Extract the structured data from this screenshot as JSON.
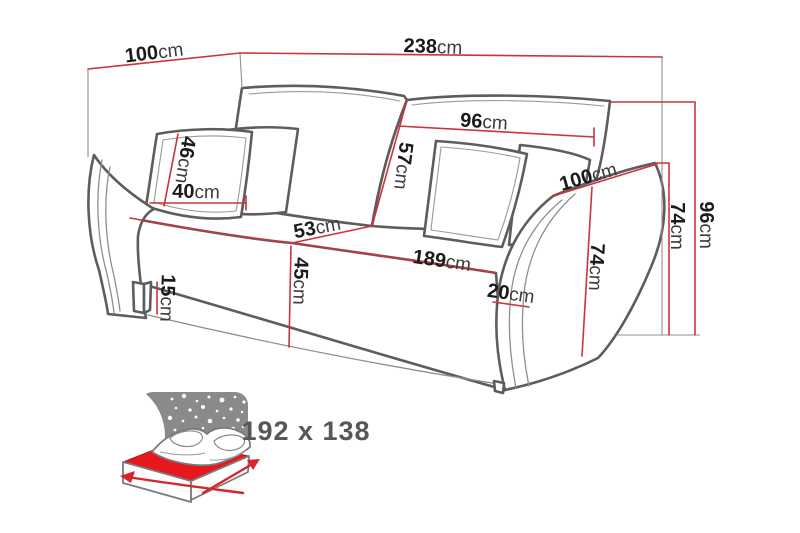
{
  "diagram": {
    "type": "sofa-bed dimension drawing",
    "unit_default": "cm"
  },
  "dims": {
    "total_width": {
      "value": "238",
      "unit": "cm"
    },
    "total_depth": {
      "value": "100",
      "unit": "cm"
    },
    "total_height": {
      "value": "96",
      "unit": "cm"
    },
    "back_cushion_width": {
      "value": "96",
      "unit": "cm"
    },
    "back_cushion_height": {
      "value": "57",
      "unit": "cm"
    },
    "pillow_height": {
      "value": "46",
      "unit": "cm"
    },
    "pillow_width": {
      "value": "40",
      "unit": "cm"
    },
    "seat_depth": {
      "value": "53",
      "unit": "cm"
    },
    "seat_height": {
      "value": "45",
      "unit": "cm"
    },
    "seat_width": {
      "value": "189",
      "unit": "cm"
    },
    "leg_height": {
      "value": "15",
      "unit": "cm"
    },
    "armrest_width": {
      "value": "20",
      "unit": "cm"
    },
    "armrest_depth": {
      "value": "100",
      "unit": "cm"
    },
    "armrest_height": {
      "value": "74",
      "unit": "cm"
    },
    "armrest_height_inner": {
      "value": "74",
      "unit": "cm"
    }
  },
  "sleeping_area": {
    "label": "192 x 138",
    "icon": "bed-night-sky-icon"
  },
  "colors": {
    "dimension_line": "#cb3339",
    "sofa_outline": "#5d5d5d",
    "sky_panel": "#8a8a8a",
    "mattress": "#e8171c",
    "bed_arrow": "#d6252b",
    "number_text": "#1b1b1b",
    "unit_text": "#3c3c3c",
    "bed_label_text": "#575757"
  }
}
